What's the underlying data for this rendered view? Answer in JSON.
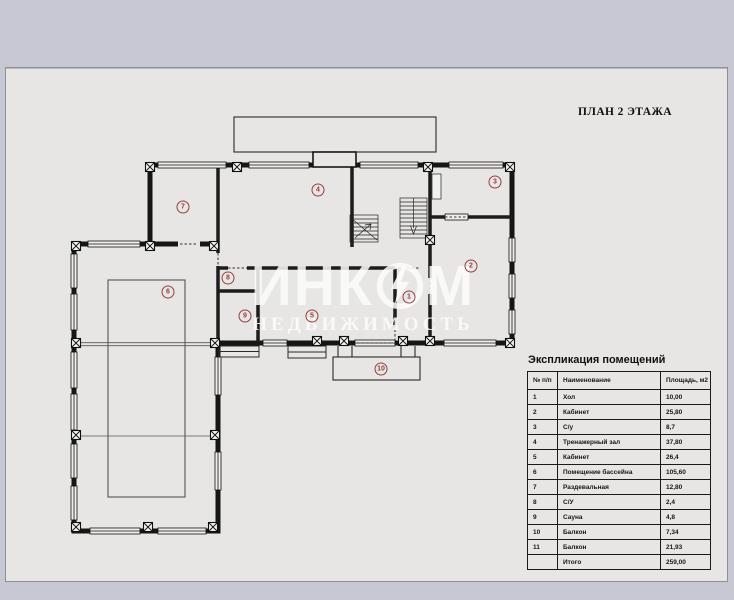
{
  "title": "ПЛАН 2 ЭТАЖА",
  "watermark": {
    "brand_left": "ИНК",
    "brand_right": "М",
    "subtitle": "НЕДВИЖИМОСТЬ",
    "logo": "incom-lightning-circle"
  },
  "colors": {
    "page_background": "#c8c7d4",
    "sheet_background": "#e7e6e4",
    "line": "#1a1a1a",
    "room_label": "#93403d"
  },
  "plan": {
    "rooms": [
      {
        "number": "1",
        "x": 409,
        "y": 297
      },
      {
        "number": "2",
        "x": 471,
        "y": 266
      },
      {
        "number": "3",
        "x": 495,
        "y": 182
      },
      {
        "number": "4",
        "x": 318,
        "y": 190
      },
      {
        "number": "5",
        "x": 312,
        "y": 316
      },
      {
        "number": "6",
        "x": 168,
        "y": 292
      },
      {
        "number": "7",
        "x": 183,
        "y": 207
      },
      {
        "number": "8",
        "x": 228,
        "y": 278
      },
      {
        "number": "9",
        "x": 245,
        "y": 316
      },
      {
        "number": "10",
        "x": 381,
        "y": 369
      }
    ]
  },
  "legend": {
    "title": "Экспликация помещений",
    "columns": [
      "№ п/п",
      "Наименование",
      "Площадь, м2"
    ],
    "rows": [
      {
        "num": "1",
        "name": "Хол",
        "area": "10,00"
      },
      {
        "num": "2",
        "name": "Кабинет",
        "area": "25,80"
      },
      {
        "num": "3",
        "name": "С/у",
        "area": "8,7"
      },
      {
        "num": "4",
        "name": "Тренажерный зал",
        "area": "37,80"
      },
      {
        "num": "5",
        "name": "Кабинет",
        "area": "26,4"
      },
      {
        "num": "6",
        "name": "Помещение бассейна",
        "area": "105,60"
      },
      {
        "num": "7",
        "name": "Раздевальная",
        "area": "12,80"
      },
      {
        "num": "8",
        "name": "С/У",
        "area": "2,4"
      },
      {
        "num": "9",
        "name": "Сауна",
        "area": "4,8"
      },
      {
        "num": "10",
        "name": "Балкон",
        "area": "7,34"
      },
      {
        "num": "11",
        "name": "Балкон",
        "area": "21,93"
      },
      {
        "num": "",
        "name": "Итого",
        "area": "259,00"
      }
    ]
  }
}
